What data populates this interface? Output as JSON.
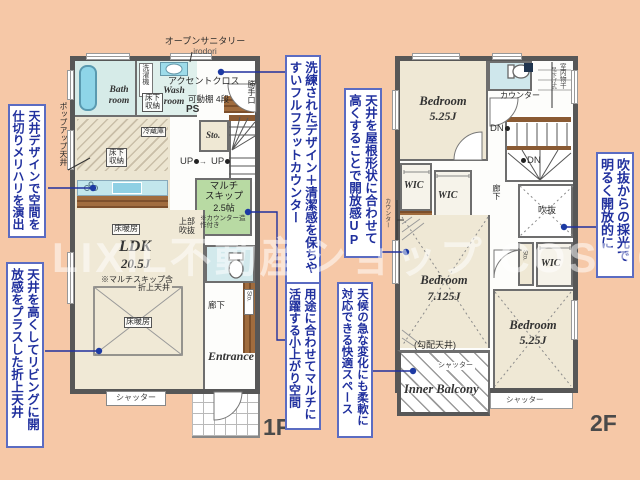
{
  "watermark": {
    "text": "LIXIL不動産ショップ COSMO"
  },
  "callouts": {
    "c1": "天井デザインで空間を仕切りメリハリを演出",
    "c2": "天井を高くしてリビングに開放感をプラスした折上天井",
    "c3": "洗練されたデザイン＋清潔感を保ちやすいフルフラットカウンター",
    "c4": "用途に合わせてマルチに活躍する小上がり空間",
    "c5": "天井を屋根形状に合わせて高くすることで開放感UP",
    "c6": "天候の急な変化にも柔軟に対応できる快適スペース",
    "c7": "吹抜からの採光で明るく開放的に"
  },
  "floor1": {
    "floor_label": "1F",
    "labels": {
      "open_sanitary": "オープンサニタリー",
      "open_sanitary_sub": "irodori",
      "accent_cloth": "アクセントクロス",
      "washer": "洗濯機",
      "bath_room": "Bath room",
      "wash_room": "Wash room",
      "underfloor_storage_a": "床下収納",
      "movable_shelf": "可動棚 4段",
      "ps": "PS",
      "kitchen_door": "勝手口",
      "popup_ceiling": "ポップアップ天井",
      "refrigerator": "冷蔵庫",
      "underfloor_storage_b": "床下収納",
      "storage": "Sto.",
      "up_a": "UP",
      "up_arrow": "→",
      "up_b": "UP",
      "multi_skip_l1": "マルチ",
      "multi_skip_l2": "スキップ",
      "multi_skip_size": "2.5帖",
      "multi_skip_note": "※カウンター造作付き",
      "upper_void": "上部吹抜",
      "floor_heating_a": "床暖房",
      "ldk_name": "LDK",
      "ldk_size": "20.5J",
      "ldk_note": "※マルチスキップ含",
      "folded_ceiling": "折上天井",
      "floor_heating_b": "床暖房",
      "hallway": "廊下",
      "entrance_storage": "Sto.",
      "entrance": "Entrance",
      "shutter": "シャッター"
    }
  },
  "floor2": {
    "floor_label": "2F",
    "labels": {
      "bedroom1_name": "Bedroom",
      "bedroom1_size": "5.25J",
      "counter_top": "カウンター",
      "indoor_drying": "室内物干",
      "indoor_drying_sub": "吊下げ式",
      "dn_a": "DN",
      "dn_b": "DN",
      "wic_a": "WIC",
      "wic_b": "WIC",
      "counter_side": "カウンター",
      "hallway": "廊下",
      "void": "吹抜",
      "bedroom2_name": "Bedroom",
      "bedroom2_size": "7.125J",
      "sloped_ceiling": "(勾配天井)",
      "storage": "Sto.",
      "wic_c": "WIC",
      "bedroom3_name": "Bedroom",
      "bedroom3_size": "5.25J",
      "inner_balcony": "Inner Balcony",
      "shutter_a": "シャッター",
      "shutter_b": "シャッター"
    }
  }
}
